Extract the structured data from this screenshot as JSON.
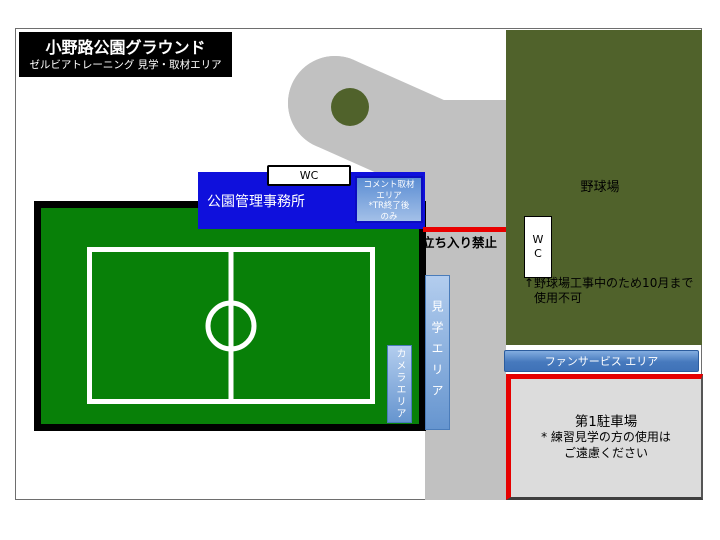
{
  "title": {
    "line1": "小野路公園グラウンド",
    "line2": "ゼルビアトレーニング 見学・取材エリア"
  },
  "office": {
    "label": "公園管理事務所"
  },
  "wc_top": {
    "label": "WC"
  },
  "comment_area": {
    "lines": [
      "コメント取材",
      "エリア",
      "*TR終了後",
      "のみ"
    ]
  },
  "no_entry": {
    "label": "立ち入り禁止"
  },
  "baseball": {
    "label": "野球場",
    "wc": {
      "line1": "W",
      "line2": "C"
    },
    "notice_line1": "↑野球場工事中のため10月まで",
    "notice_line2": "使用不可"
  },
  "viewing_area": {
    "label": "見学エリア"
  },
  "camera_area": {
    "label": "カメラエリア"
  },
  "fan_service": {
    "label": "ファンサービス エリア"
  },
  "parking": {
    "line1": "第1駐車場",
    "line2": "* 練習見学の方の使用は",
    "line3": "ご遠慮ください"
  },
  "colors": {
    "road_gray": "#c1c1c1",
    "olive_green": "#50622b",
    "pitch_green": "#088008",
    "office_blue": "#0f10dc",
    "area_blue": "#6695cf",
    "warning_red": "#e60000",
    "parking_gray": "#dcdcdc",
    "frame_gray": "#6e6e6e"
  }
}
